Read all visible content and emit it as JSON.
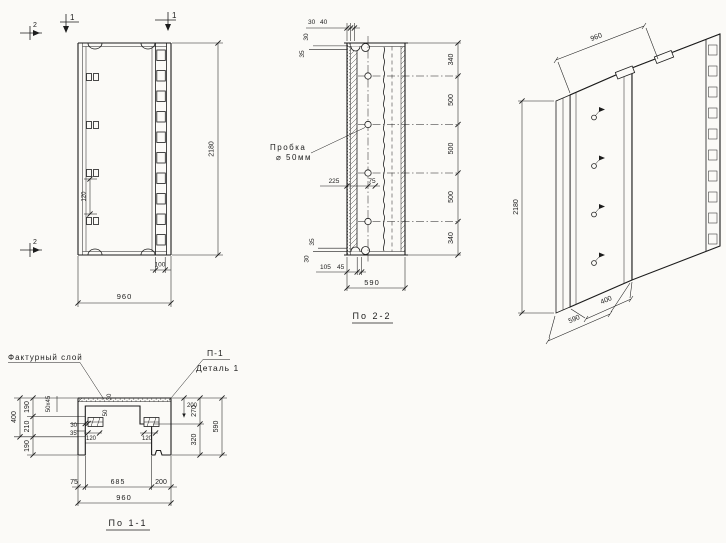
{
  "drawing": {
    "ink": "#1c1c1c",
    "paper": "#fbfaf7",
    "views": {
      "elevation": {
        "section_mark_1": "1",
        "section_mark_2": "2",
        "dim_width": "960",
        "dim_height": "2180",
        "dim_key": "100",
        "dim_hook": "120"
      },
      "section_2": {
        "title": "По 2-2",
        "plug_label_line1": "Пробка",
        "plug_label_line2": "⌀ 50мм",
        "dim_top_a": "30",
        "dim_top_b": "40",
        "dim_left_top_a": "30",
        "dim_left_top_b": "35",
        "dim_left_bottom_a": "35",
        "dim_left_bottom_b": "30",
        "dim_plug_offset": "225",
        "dim_plug_inner": "75",
        "dim_bottom_a": "105",
        "dim_bottom_b": "45",
        "dim_width": "590",
        "right_chain": [
          "340",
          "500",
          "500",
          "500",
          "340"
        ]
      },
      "isometric": {
        "dim_width": "960",
        "dim_height": "2180",
        "dim_depth_a": "400",
        "dim_depth_b": "590"
      },
      "section_1": {
        "title": "По 1-1",
        "label_facing": "Фактурный слой",
        "label_p1": "П-1",
        "label_detail": "Деталь 1",
        "dim_chamfer": "50х45",
        "dim_facing": "30",
        "dim_layer": "50",
        "dim_plate_offset": "30",
        "dim_plate_gap": "35",
        "dim_plate_left": "120",
        "dim_plate_right": "120",
        "dim_pocket": "200",
        "right_chain": [
          "270",
          "320"
        ],
        "dim_depth": "590",
        "left_overall": "400",
        "left_chain": [
          "190",
          "210",
          "190"
        ],
        "bottom_chain": [
          "75",
          "685",
          "200"
        ],
        "dim_width": "960"
      }
    }
  }
}
